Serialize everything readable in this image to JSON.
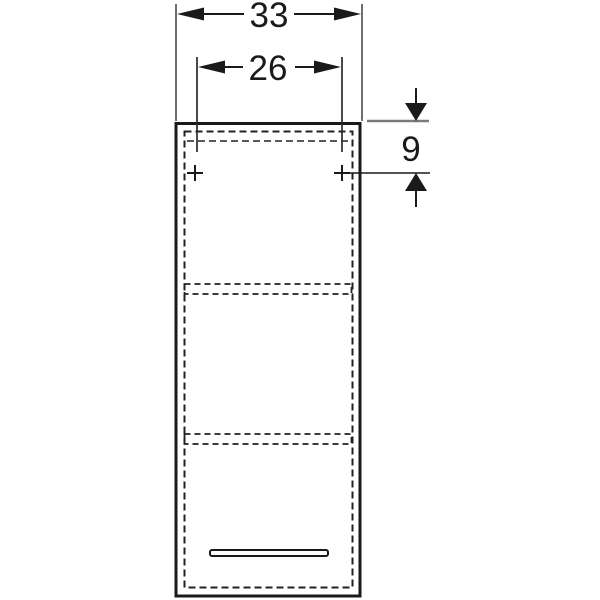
{
  "drawing": {
    "title": "wall-cabinet-front-elevation",
    "background_color": "#ffffff",
    "outline_color": "#1a1a1a",
    "extension_line_color": "#6f6f6f",
    "dimensions": {
      "outer_width": {
        "value": "33"
      },
      "fixing_hole_spacing": {
        "value": "26"
      },
      "fixing_hole_top_offset": {
        "value": "9"
      }
    },
    "features": {
      "mounting_points_count": "2",
      "shelves_count": "2",
      "handles_count": "1"
    }
  }
}
